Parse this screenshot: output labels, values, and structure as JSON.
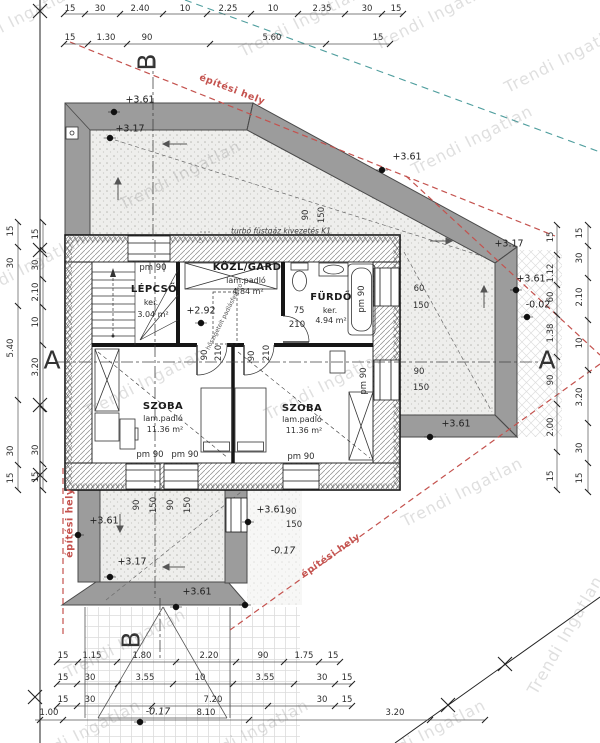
{
  "document": {
    "type": "architectural floor plan",
    "language": "hu"
  },
  "watermark": {
    "text": "Trendi Ingatlan",
    "positions": [
      {
        "x": 15,
        "y": 20
      },
      {
        "x": 300,
        "y": 22
      },
      {
        "x": 435,
        "y": 15
      },
      {
        "x": 565,
        "y": 58
      },
      {
        "x": 472,
        "y": 140
      },
      {
        "x": 180,
        "y": 175
      },
      {
        "x": 25,
        "y": 268
      },
      {
        "x": 145,
        "y": 382
      },
      {
        "x": 325,
        "y": 385
      },
      {
        "x": 462,
        "y": 492
      },
      {
        "x": 125,
        "y": 643
      },
      {
        "x": 565,
        "y": 635,
        "r": -60
      },
      {
        "x": 80,
        "y": 734
      },
      {
        "x": 248,
        "y": 734
      },
      {
        "x": 425,
        "y": 734
      }
    ]
  },
  "colors": {
    "roof_band": "#9c9c9c",
    "envelope_red": "#c4524e",
    "utility_teal": "#4f9e9e",
    "wall_line": "#161616"
  },
  "plan_annotations": {
    "dim_top": [
      {
        "t": "15",
        "x": 70,
        "y": 9
      },
      {
        "t": "30",
        "x": 100,
        "y": 9
      },
      {
        "t": "2.40",
        "x": 140,
        "y": 9
      },
      {
        "t": "10",
        "x": 185,
        "y": 9
      },
      {
        "t": "2.25",
        "x": 228,
        "y": 9
      },
      {
        "t": "10",
        "x": 273,
        "y": 9
      },
      {
        "t": "2.35",
        "x": 322,
        "y": 9
      },
      {
        "t": "30",
        "x": 367,
        "y": 9
      },
      {
        "t": "15",
        "x": 396,
        "y": 9
      },
      {
        "t": "15",
        "x": 70,
        "y": 38
      },
      {
        "t": "1.30",
        "x": 106,
        "y": 38
      },
      {
        "t": "90",
        "x": 147,
        "y": 38
      },
      {
        "t": "5.60",
        "x": 272,
        "y": 38
      },
      {
        "t": "15",
        "x": 378,
        "y": 38
      }
    ],
    "dim_bottom": [
      {
        "t": "15",
        "x": 63,
        "y": 656
      },
      {
        "t": "1.15",
        "x": 92,
        "y": 656
      },
      {
        "t": "1.80",
        "x": 142,
        "y": 656
      },
      {
        "t": "2.20",
        "x": 209,
        "y": 656
      },
      {
        "t": "90",
        "x": 263,
        "y": 656
      },
      {
        "t": "1.75",
        "x": 304,
        "y": 656
      },
      {
        "t": "15",
        "x": 333,
        "y": 656
      },
      {
        "t": "15",
        "x": 63,
        "y": 678
      },
      {
        "t": "30",
        "x": 90,
        "y": 678
      },
      {
        "t": "3.55",
        "x": 145,
        "y": 678
      },
      {
        "t": "10",
        "x": 200,
        "y": 678
      },
      {
        "t": "3.55",
        "x": 265,
        "y": 678
      },
      {
        "t": "30",
        "x": 322,
        "y": 678
      },
      {
        "t": "15",
        "x": 347,
        "y": 678
      },
      {
        "t": "15",
        "x": 63,
        "y": 700
      },
      {
        "t": "30",
        "x": 90,
        "y": 700
      },
      {
        "t": "7.20",
        "x": 213,
        "y": 700
      },
      {
        "t": "30",
        "x": 322,
        "y": 700
      },
      {
        "t": "15",
        "x": 347,
        "y": 700
      },
      {
        "t": "1.00",
        "x": 49,
        "y": 713
      },
      {
        "t": "8.10",
        "x": 206,
        "y": 713
      },
      {
        "t": "3.20",
        "x": 395,
        "y": 713
      }
    ],
    "dim_left": [
      {
        "t": "15",
        "x": 11,
        "y": 231,
        "r": -90
      },
      {
        "t": "30",
        "x": 11,
        "y": 263,
        "r": -90
      },
      {
        "t": "5.40",
        "x": 11,
        "y": 348,
        "r": -90
      },
      {
        "t": "30",
        "x": 11,
        "y": 451,
        "r": -90
      },
      {
        "t": "15",
        "x": 11,
        "y": 478,
        "r": -90
      },
      {
        "t": "15",
        "x": 36,
        "y": 234,
        "r": -90
      },
      {
        "t": "30",
        "x": 36,
        "y": 265,
        "r": -90
      },
      {
        "t": "2.10",
        "x": 36,
        "y": 292,
        "r": -90
      },
      {
        "t": "10",
        "x": 36,
        "y": 322,
        "r": -90
      },
      {
        "t": "3.20",
        "x": 36,
        "y": 367,
        "r": -90
      },
      {
        "t": "30",
        "x": 36,
        "y": 450,
        "r": -90
      },
      {
        "t": "15",
        "x": 36,
        "y": 477,
        "r": -90
      }
    ],
    "dim_right": [
      {
        "t": "15",
        "x": 551,
        "y": 237,
        "r": -90
      },
      {
        "t": "1.12",
        "x": 551,
        "y": 273,
        "r": -90
      },
      {
        "t": "60",
        "x": 551,
        "y": 297,
        "r": -90
      },
      {
        "t": "1.38",
        "x": 551,
        "y": 333,
        "r": -90
      },
      {
        "t": "90",
        "x": 551,
        "y": 380,
        "r": -90
      },
      {
        "t": "2.00",
        "x": 551,
        "y": 427,
        "r": -90
      },
      {
        "t": "15",
        "x": 551,
        "y": 476,
        "r": -90
      },
      {
        "t": "15",
        "x": 580,
        "y": 233,
        "r": -90
      },
      {
        "t": "30",
        "x": 580,
        "y": 258,
        "r": -90
      },
      {
        "t": "2.10",
        "x": 580,
        "y": 297,
        "r": -90
      },
      {
        "t": "10",
        "x": 580,
        "y": 343,
        "r": -90
      },
      {
        "t": "3.20",
        "x": 580,
        "y": 397,
        "r": -90
      },
      {
        "t": "30",
        "x": 580,
        "y": 448,
        "r": -90
      },
      {
        "t": "15",
        "x": 580,
        "y": 478,
        "r": -90
      }
    ],
    "levels": [
      {
        "t": "+3.61",
        "x": 140,
        "y": 100,
        "c": "lv"
      },
      {
        "t": "+3.17",
        "x": 130,
        "y": 129,
        "c": "lv"
      },
      {
        "t": "+3.61",
        "x": 407,
        "y": 157,
        "c": "lv"
      },
      {
        "t": "+3.17",
        "x": 509,
        "y": 244,
        "c": "lv"
      },
      {
        "t": "+3.61",
        "x": 531,
        "y": 279,
        "c": "lv"
      },
      {
        "t": "-0.02",
        "x": 538,
        "y": 305,
        "c": "lv"
      },
      {
        "t": "+3.61",
        "x": 456,
        "y": 424,
        "c": "lv"
      },
      {
        "t": "+2.92",
        "x": 201,
        "y": 311,
        "c": "lv"
      },
      {
        "t": "+3.61",
        "x": 104,
        "y": 521,
        "c": "lv"
      },
      {
        "t": "+3.17",
        "x": 132,
        "y": 562,
        "c": "lv"
      },
      {
        "t": "+3.61",
        "x": 197,
        "y": 592,
        "c": "lv"
      },
      {
        "t": "+3.61",
        "x": 271,
        "y": 510,
        "c": "lv"
      },
      {
        "t": "-0.17",
        "x": 283,
        "y": 551,
        "c": "lvi"
      },
      {
        "t": "-0.17",
        "x": 158,
        "y": 712,
        "c": "lvi"
      }
    ],
    "rooms": [
      {
        "t": "LÉPCSŐ",
        "x": 154,
        "y": 290,
        "c": "rm"
      },
      {
        "t": "ker.",
        "x": 151,
        "y": 303,
        "c": "sb"
      },
      {
        "t": "3.04 m²",
        "x": 153,
        "y": 315,
        "c": "sb"
      },
      {
        "t": "KÖZL/GARD",
        "x": 247,
        "y": 268,
        "c": "rm"
      },
      {
        "t": "lam.padló",
        "x": 246,
        "y": 281,
        "c": "sb"
      },
      {
        "t": "4.84 m²",
        "x": 248,
        "y": 292,
        "c": "sb"
      },
      {
        "t": "FÜRDŐ",
        "x": 331,
        "y": 298,
        "c": "rm"
      },
      {
        "t": "ker.",
        "x": 330,
        "y": 311,
        "c": "sb"
      },
      {
        "t": "4.94 m²",
        "x": 331,
        "y": 321,
        "c": "sb"
      },
      {
        "t": "SZOBA",
        "x": 163,
        "y": 407,
        "c": "rm"
      },
      {
        "t": "lam.padló",
        "x": 163,
        "y": 419,
        "c": "sb"
      },
      {
        "t": "11.36 m²",
        "x": 165,
        "y": 430,
        "c": "sb"
      },
      {
        "t": "SZOBA",
        "x": 302,
        "y": 409,
        "c": "rm"
      },
      {
        "t": "lam.padló",
        "x": 302,
        "y": 420,
        "c": "sb"
      },
      {
        "t": "11.36 m²",
        "x": 304,
        "y": 431,
        "c": "sb"
      }
    ],
    "openings": [
      {
        "t": "pm 90",
        "x": 153,
        "y": 268
      },
      {
        "t": "pm 90",
        "x": 150,
        "y": 455
      },
      {
        "t": "pm 90",
        "x": 185,
        "y": 455
      },
      {
        "t": "pm 90",
        "x": 301,
        "y": 457
      },
      {
        "t": "pm 90",
        "x": 362,
        "y": 299,
        "r": -90
      },
      {
        "t": "pm 90",
        "x": 364,
        "y": 381,
        "r": -90
      },
      {
        "t": "90",
        "x": 205,
        "y": 355,
        "r": -90
      },
      {
        "t": "210",
        "x": 219,
        "y": 353,
        "r": -90
      },
      {
        "t": "90",
        "x": 252,
        "y": 356,
        "r": -90
      },
      {
        "t": "210",
        "x": 267,
        "y": 353,
        "r": -90
      },
      {
        "t": "75",
        "x": 299,
        "y": 311
      },
      {
        "t": "210",
        "x": 297,
        "y": 325
      },
      {
        "t": "60",
        "x": 419,
        "y": 289
      },
      {
        "t": "150",
        "x": 421,
        "y": 306
      },
      {
        "t": "90",
        "x": 419,
        "y": 372
      },
      {
        "t": "150",
        "x": 421,
        "y": 388
      },
      {
        "t": "90",
        "x": 306,
        "y": 215,
        "r": -90
      },
      {
        "t": "150",
        "x": 322,
        "y": 215,
        "r": -90
      },
      {
        "t": "90",
        "x": 137,
        "y": 505,
        "r": -90
      },
      {
        "t": "150",
        "x": 154,
        "y": 505,
        "r": -90
      },
      {
        "t": "90",
        "x": 171,
        "y": 505,
        "r": -90
      },
      {
        "t": "150",
        "x": 188,
        "y": 505,
        "r": -90
      },
      {
        "t": "90",
        "x": 291,
        "y": 512
      },
      {
        "t": "150",
        "x": 294,
        "y": 525
      }
    ],
    "sections": [
      {
        "t": "B",
        "x": 147,
        "y": 62,
        "r": -90,
        "c": "sec"
      },
      {
        "t": "B",
        "x": 131,
        "y": 640,
        "r": -90,
        "c": "sec"
      },
      {
        "t": "A",
        "x": 52,
        "y": 360,
        "c": "sec"
      },
      {
        "t": "A",
        "x": 547,
        "y": 360,
        "c": "sec"
      }
    ],
    "site": [
      {
        "t": "építési hely",
        "x": 232,
        "y": 90,
        "r": 21,
        "c": "rd"
      },
      {
        "t": "építési hely",
        "x": 70,
        "y": 523,
        "r": -90,
        "c": "rd"
      },
      {
        "t": "építési hely",
        "x": 331,
        "y": 556,
        "r": -35,
        "c": "rd"
      }
    ],
    "notes": [
      {
        "t": "turbó füstgáz kivezetés K1",
        "x": 281,
        "y": 231,
        "c": "nt"
      },
      {
        "t": "hőszigetelt padlásfeljáró",
        "x": 225,
        "y": 317,
        "r": -63,
        "c": "ty"
      }
    ]
  }
}
